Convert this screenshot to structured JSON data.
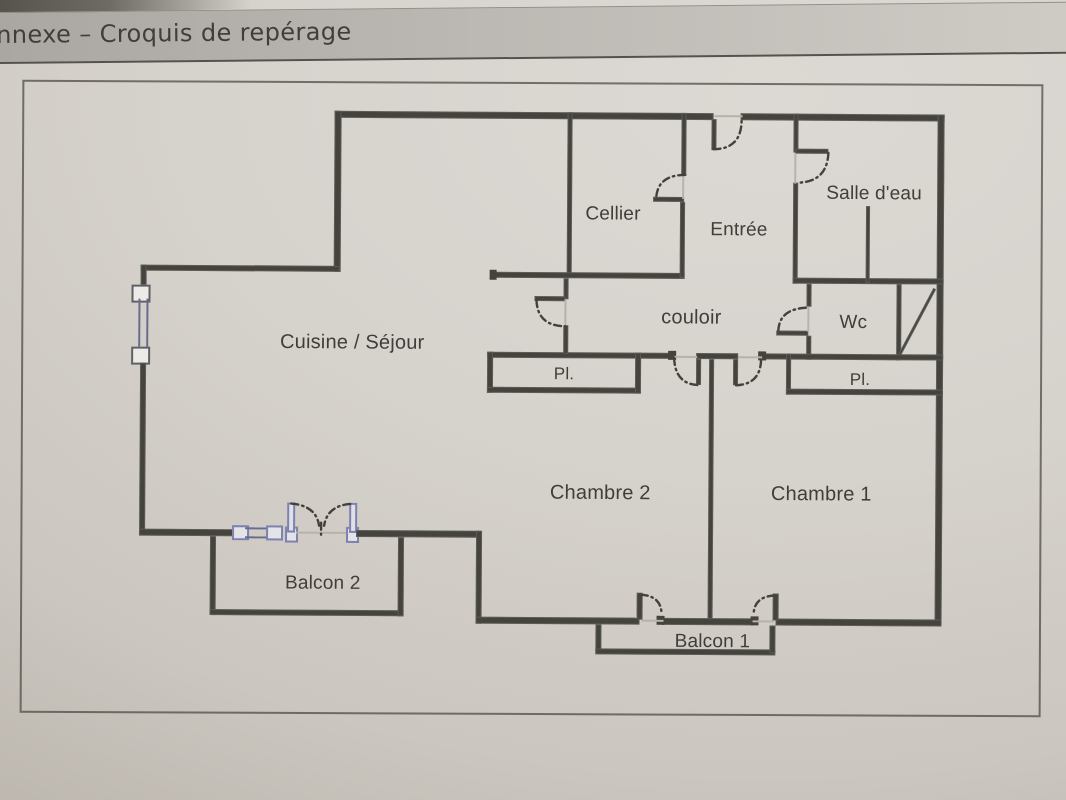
{
  "header": {
    "title": "nnexe – Croquis de repérage"
  },
  "colors": {
    "wall": "#45433e",
    "window_accent": "#7c81ad",
    "paper": "#d4d0ca",
    "ink": "#403e3a",
    "door_arc": "#44413d"
  },
  "floor_plan": {
    "rooms": [
      {
        "id": "cuisine-sejour",
        "label": "Cuisine / Séjour",
        "x": 352,
        "y": 344,
        "fs": 20
      },
      {
        "id": "cellier",
        "label": "Cellier",
        "x": 612,
        "y": 214,
        "fs": 19
      },
      {
        "id": "entree",
        "label": "Entrée",
        "x": 738,
        "y": 229,
        "fs": 19
      },
      {
        "id": "salle-d-eau",
        "label": "Salle d'eau",
        "x": 873,
        "y": 192,
        "fs": 19
      },
      {
        "id": "couloir",
        "label": "couloir",
        "x": 691,
        "y": 317,
        "fs": 20
      },
      {
        "id": "wc",
        "label": "Wc",
        "x": 853,
        "y": 321,
        "fs": 19
      },
      {
        "id": "placard-chambre-2",
        "label": "Pl.",
        "x": 564,
        "y": 374,
        "fs": 17
      },
      {
        "id": "placard-chambre-1",
        "label": "Pl.",
        "x": 860,
        "y": 378,
        "fs": 17
      },
      {
        "id": "chambre-2",
        "label": "Chambre 2",
        "x": 601,
        "y": 493,
        "fs": 20
      },
      {
        "id": "chambre-1",
        "label": "Chambre 1",
        "x": 822,
        "y": 493,
        "fs": 20
      },
      {
        "id": "balcon-2",
        "label": "Balcon 2",
        "x": 324,
        "y": 585,
        "fs": 19
      },
      {
        "id": "balcon-1",
        "label": "Balcon 1",
        "x": 714,
        "y": 641,
        "fs": 19
      }
    ]
  }
}
